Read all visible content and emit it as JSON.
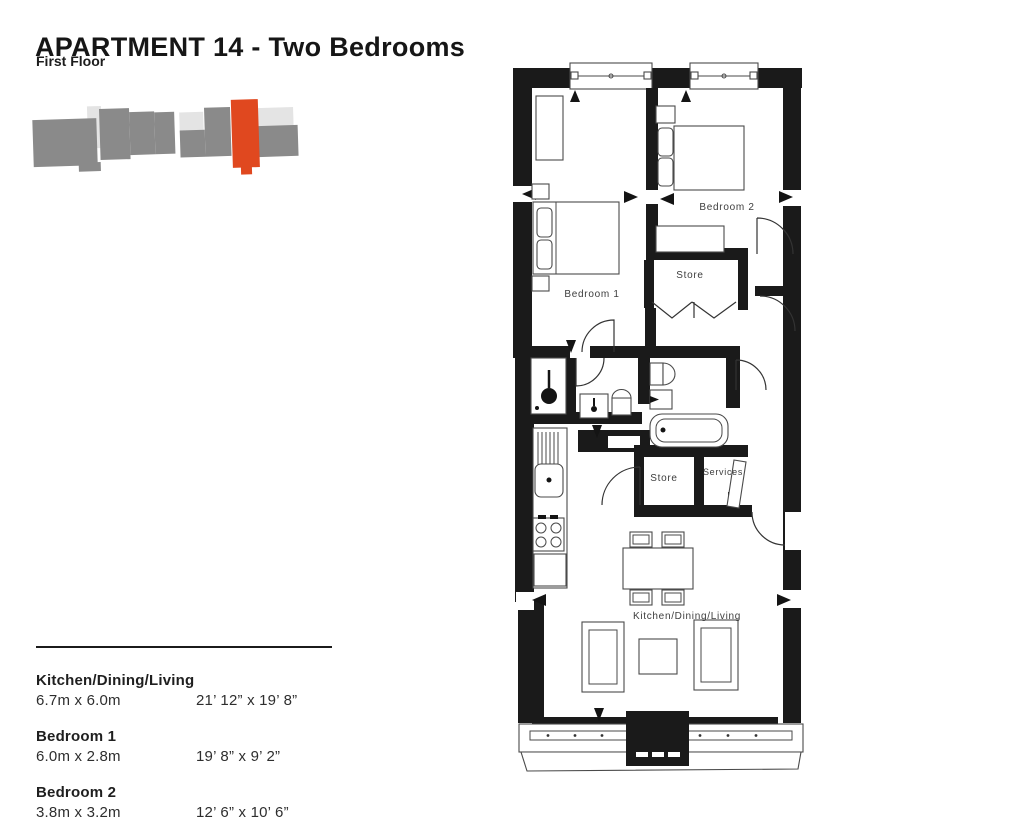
{
  "header": {
    "title": "APARTMENT 14 - Two Bedrooms",
    "subtitle": "First Floor"
  },
  "key_plan": {
    "highlight_color": "#E0481F",
    "block_color": "#8A8A8A",
    "light_block_color": "#E4E4E4",
    "highlighted_unit": "Apartment 14"
  },
  "floor_plan": {
    "labels": {
      "bedroom1": "Bedroom 1",
      "bedroom2": "Bedroom 2",
      "store_upper": "Store",
      "store_lower": "Store",
      "services": "Services",
      "kitchen_dining_living": "Kitchen/Dining/Living"
    }
  },
  "dimensions": {
    "rows": [
      {
        "room": "Kitchen/Dining/Living",
        "metric": "6.7m x 6.0m",
        "imperial": "21’ 12” x 19’ 8”"
      },
      {
        "room": "Bedroom 1",
        "metric": "6.0m x 2.8m",
        "imperial": "19’ 8” x 9’ 2”"
      },
      {
        "room": "Bedroom 2",
        "metric": "3.8m x 3.2m",
        "imperial": "12’ 6” x 10’ 6”"
      }
    ]
  }
}
